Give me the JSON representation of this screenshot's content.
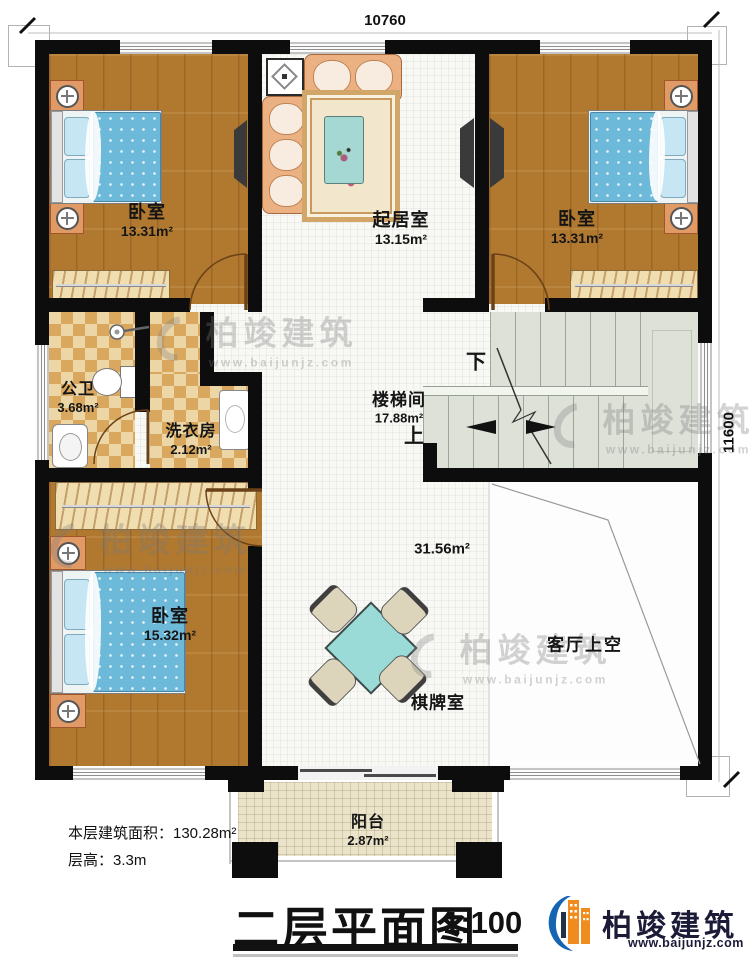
{
  "dimensions": {
    "top": "10760",
    "right": "11600"
  },
  "rooms": {
    "bedroom_tl": {
      "name": "卧室",
      "area": "13.31m²"
    },
    "living": {
      "name": "起居室",
      "area": "13.15m²"
    },
    "bedroom_tr": {
      "name": "卧室",
      "area": "13.31m²"
    },
    "bathroom": {
      "name": "公卫",
      "area": "3.68m²"
    },
    "laundry": {
      "name": "洗衣房",
      "area": "2.12m²"
    },
    "stairwell": {
      "name": "楼梯间",
      "area": "17.88m²",
      "down": "下",
      "up": "上"
    },
    "bedroom_bl": {
      "name": "卧室",
      "area": "15.32m²"
    },
    "gameroom": {
      "name": "棋牌室",
      "area": "31.56m²"
    },
    "void": {
      "name": "客厅上空"
    },
    "balcony": {
      "name": "阳台",
      "area": "2.87m²"
    }
  },
  "notes": {
    "floor_area": "本层建筑面积：130.28m²",
    "floor_height": "层高：3.3m"
  },
  "titleblock": {
    "title": "二层平面图",
    "scale": "1:100"
  },
  "brand": {
    "name": "柏竣建筑",
    "url": "www.baijunjz.com"
  },
  "watermark": {
    "name": "柏竣建筑",
    "url": "www.baijunjz.com"
  },
  "colors": {
    "wall": "#0d0d0d",
    "wood": "#b1782f",
    "tile": "#ecd6a6",
    "stair": "#dde1d8",
    "brand_blue": "#1665b2",
    "brand_orange": "#f08c1e"
  }
}
